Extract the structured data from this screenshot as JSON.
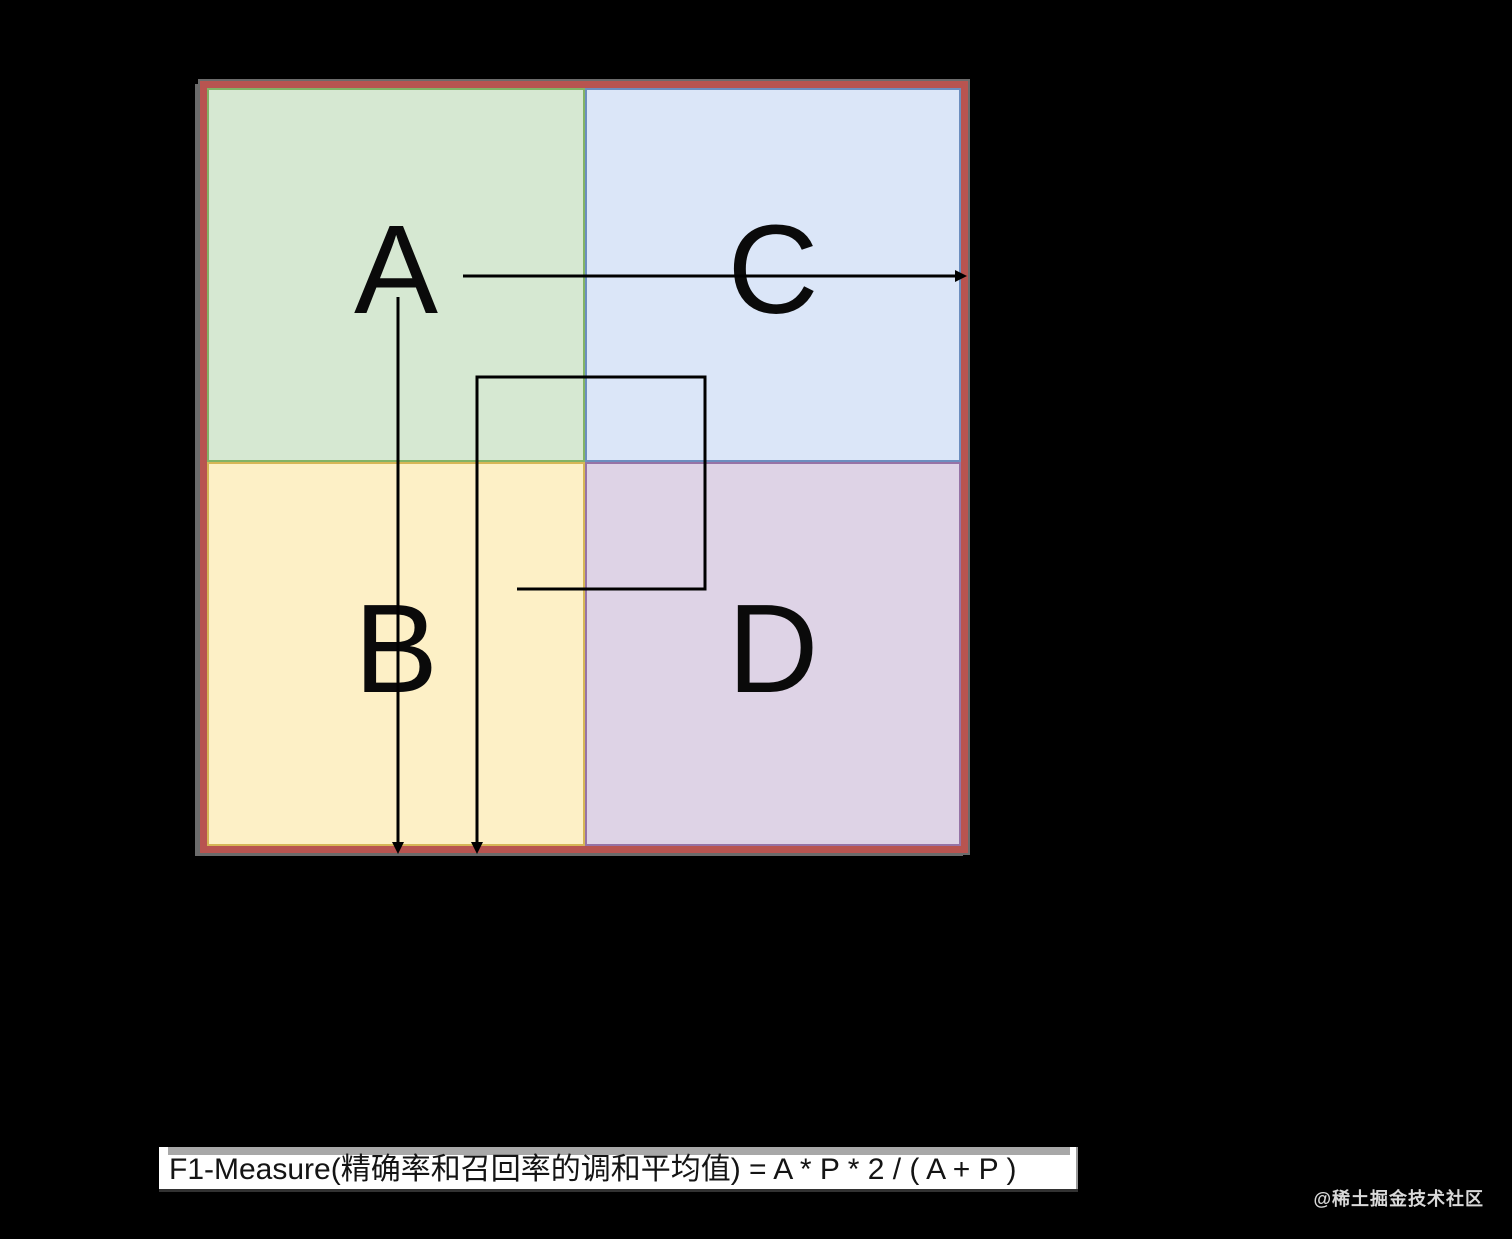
{
  "page": {
    "width": 1512,
    "height": 1239,
    "kind": "quadrant-diagram"
  },
  "colors": {
    "background": "#000000",
    "square_border": "#b85450",
    "square_edge": "#6b6b6b",
    "line": "#000000",
    "bar_bg": "#ffffff",
    "bar_strip": "#a8a8a8",
    "bar_text": "#141414",
    "watermark_text": "#d9d9d9"
  },
  "diagram": {
    "quadrants": [
      {
        "id": "A",
        "label": "A",
        "position": "top-left",
        "fill": "#d6e8d2",
        "border": "#82b366"
      },
      {
        "id": "C",
        "label": "C",
        "position": "top-right",
        "fill": "#dbe6f8",
        "border": "#6c8ebf"
      },
      {
        "id": "B",
        "label": "B",
        "position": "bottom-left",
        "fill": "#fdf0c6",
        "border": "#d6b656"
      },
      {
        "id": "D",
        "label": "D",
        "position": "bottom-right",
        "fill": "#ded3e6",
        "border": "#9673a6"
      }
    ]
  },
  "formula_bar": {
    "text": "F1-Measure(精确率和召回率的调和平均值) = A * P * 2 / ( A + P )"
  },
  "watermark": {
    "text": "@稀土掘金技术社区"
  }
}
